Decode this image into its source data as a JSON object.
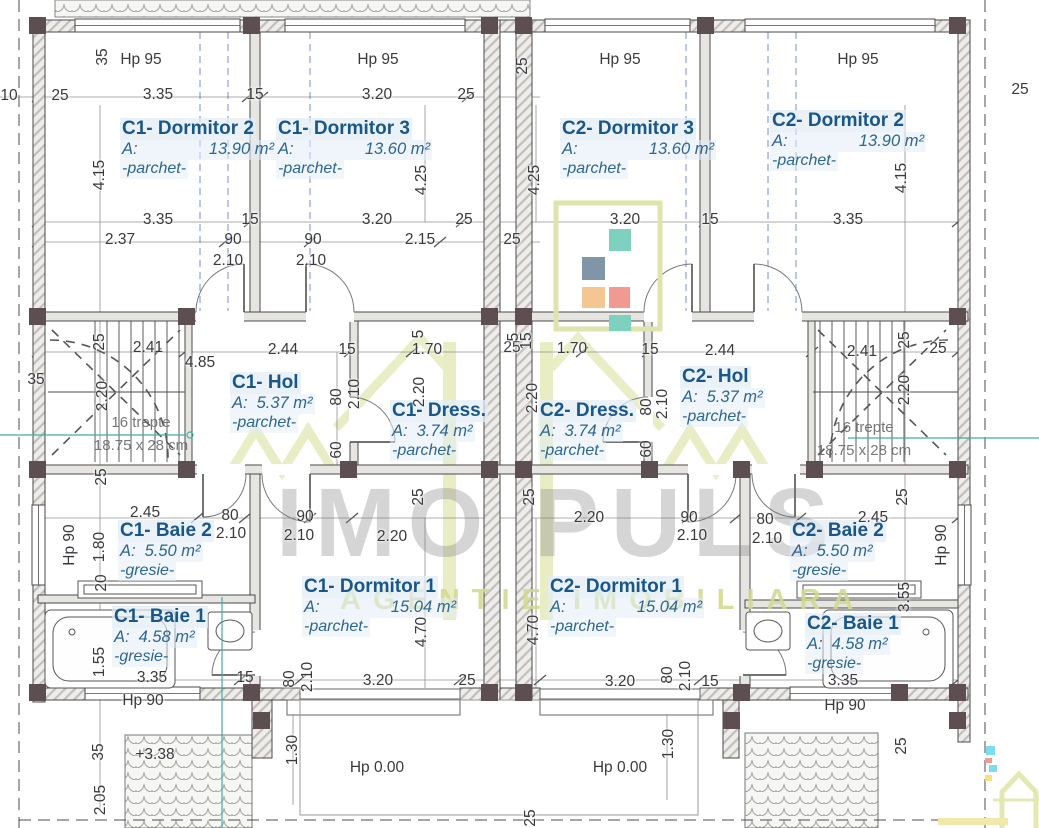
{
  "plan": {
    "watermark": {
      "brand": "IMO PULS",
      "tagline": "AGENTIE IMOBILIARA"
    },
    "stair_note": {
      "line1": "16 trepte",
      "line2": "18.75 x 28 cm"
    },
    "colors": {
      "room_label": "#19578a",
      "dimension": "#3a3a3e",
      "watermark_gray": "#bdbdbd",
      "watermark_green": "#dfe4ad",
      "logo_teal": "#7ed0bf",
      "logo_slate": "#8195a9",
      "logo_orange": "#f4c792",
      "logo_coral": "#f09a92",
      "axis_blue": "#5b6cc7",
      "level_teal": "#3ab0a5"
    },
    "rooms": [
      {
        "id": "c1-dormitor-2",
        "name": "C1- Dormitor 2",
        "area_label": "A:",
        "area": "13.90 m²",
        "finish": "-parchet-",
        "x": 120,
        "y": 118,
        "spread": true
      },
      {
        "id": "c1-dormitor-3",
        "name": "C1- Dormitor 3",
        "area_label": "A:",
        "area": "13.60 m²",
        "finish": "-parchet-",
        "x": 276,
        "y": 118,
        "spread": true
      },
      {
        "id": "c2-dormitor-3",
        "name": "C2- Dormitor 3",
        "area_label": "A:",
        "area": "13.60 m²",
        "finish": "-parchet-",
        "x": 560,
        "y": 118,
        "spread": true
      },
      {
        "id": "c2-dormitor-2",
        "name": "C2- Dormitor 2",
        "area_label": "A:",
        "area": "13.90 m²",
        "finish": "-parchet-",
        "x": 770,
        "y": 110,
        "spread": true
      },
      {
        "id": "c1-hol",
        "name": "C1- Hol",
        "area_label": "A:",
        "area": "5.37 m²",
        "finish": "-parchet-",
        "x": 230,
        "y": 372
      },
      {
        "id": "c1-dress",
        "name": "C1- Dress.",
        "area_label": "A:",
        "area": "3.74 m²",
        "finish": "-parchet-",
        "x": 390,
        "y": 400
      },
      {
        "id": "c2-dress",
        "name": "C2- Dress.",
        "area_label": "A:",
        "area": "3.74 m²",
        "finish": "-parchet-",
        "x": 538,
        "y": 400
      },
      {
        "id": "c2-hol",
        "name": "C2- Hol",
        "area_label": "A:",
        "area": "5.37 m²",
        "finish": "-parchet-",
        "x": 680,
        "y": 366
      },
      {
        "id": "c1-baie-2",
        "name": "C1- Baie 2",
        "area_label": "A:",
        "area": "5.50 m²",
        "finish": "-gresie-",
        "x": 118,
        "y": 520
      },
      {
        "id": "c2-baie-2",
        "name": "C2- Baie 2",
        "area_label": "A:",
        "area": "5.50 m²",
        "finish": "-gresie-",
        "x": 790,
        "y": 520
      },
      {
        "id": "c1-baie-1",
        "name": "C1- Baie 1",
        "area_label": "A:",
        "area": "4.58 m²",
        "finish": "-gresie-",
        "x": 112,
        "y": 606
      },
      {
        "id": "c2-baie-1",
        "name": "C2- Baie 1",
        "area_label": "A:",
        "area": "4.58 m²",
        "finish": "-gresie-",
        "x": 805,
        "y": 613
      },
      {
        "id": "c1-dormitor-1",
        "name": "C1- Dormitor 1",
        "area_label": "A:",
        "area": "15.04 m²",
        "finish": "-parchet-",
        "x": 302,
        "y": 576,
        "spread": true
      },
      {
        "id": "c2-dormitor-1",
        "name": "C2- Dormitor 1",
        "area_label": "A:",
        "area": "15.04 m²",
        "finish": "-parchet-",
        "x": 548,
        "y": 576,
        "spread": true
      }
    ],
    "labels": [
      {
        "t": "35",
        "x": 103,
        "y": 57,
        "r": 1
      },
      {
        "t": "Hp 95",
        "x": 141,
        "y": 60
      },
      {
        "t": "Hp 95",
        "x": 378,
        "y": 60
      },
      {
        "t": "25",
        "x": 523,
        "y": 66,
        "r": 1
      },
      {
        "t": "Hp 95",
        "x": 620,
        "y": 60
      },
      {
        "t": "Hp 95",
        "x": 858,
        "y": 60
      },
      {
        "t": "25",
        "x": 1020,
        "y": 90
      },
      {
        "t": "10",
        "x": 9,
        "y": 96
      },
      {
        "t": "25",
        "x": 60,
        "y": 96
      },
      {
        "t": "3.35",
        "x": 158,
        "y": 95
      },
      {
        "t": "15",
        "x": 255,
        "y": 95
      },
      {
        "t": "3.20",
        "x": 377,
        "y": 95
      },
      {
        "t": "25",
        "x": 466,
        "y": 95
      },
      {
        "t": "4.15",
        "x": 100,
        "y": 175,
        "r": 1
      },
      {
        "t": "4.25",
        "x": 422,
        "y": 180,
        "r": 1
      },
      {
        "t": "4.25",
        "x": 535,
        "y": 180,
        "r": 1
      },
      {
        "t": "4.15",
        "x": 902,
        "y": 178,
        "r": 1
      },
      {
        "t": "3.35",
        "x": 158,
        "y": 220
      },
      {
        "t": "15",
        "x": 250,
        "y": 220
      },
      {
        "t": "3.20",
        "x": 377,
        "y": 220
      },
      {
        "t": "25",
        "x": 464,
        "y": 220
      },
      {
        "t": "3.20",
        "x": 625,
        "y": 220
      },
      {
        "t": "15",
        "x": 710,
        "y": 220
      },
      {
        "t": "3.35",
        "x": 848,
        "y": 220
      },
      {
        "t": "2.37",
        "x": 120,
        "y": 240
      },
      {
        "t": "90",
        "x": 233,
        "y": 240
      },
      {
        "t": "2.10",
        "x": 228,
        "y": 261
      },
      {
        "t": "90",
        "x": 313,
        "y": 240
      },
      {
        "t": "2.10",
        "x": 311,
        "y": 261
      },
      {
        "t": "2.15",
        "x": 420,
        "y": 240
      },
      {
        "t": "25",
        "x": 512,
        "y": 240
      },
      {
        "t": "25",
        "x": 512,
        "y": 348
      },
      {
        "t": "2.41",
        "x": 148,
        "y": 348
      },
      {
        "t": "4.85",
        "x": 200,
        "y": 363
      },
      {
        "t": "2.44",
        "x": 283,
        "y": 350
      },
      {
        "t": "15",
        "x": 347,
        "y": 350
      },
      {
        "t": "1.70",
        "x": 427,
        "y": 350
      },
      {
        "t": "5",
        "x": 419,
        "y": 334,
        "r": 1
      },
      {
        "t": "5",
        "x": 514,
        "y": 337,
        "r": 1
      },
      {
        "t": "15",
        "x": 527,
        "y": 341,
        "r": 1
      },
      {
        "t": "1.70",
        "x": 572,
        "y": 349
      },
      {
        "t": "15",
        "x": 650,
        "y": 350
      },
      {
        "t": "2.44",
        "x": 720,
        "y": 351
      },
      {
        "t": "2.41",
        "x": 862,
        "y": 352
      },
      {
        "t": "25",
        "x": 938,
        "y": 349
      },
      {
        "t": "35",
        "x": 36,
        "y": 380
      },
      {
        "t": "25",
        "x": 100,
        "y": 342,
        "r": 1
      },
      {
        "t": "25",
        "x": 905,
        "y": 340,
        "r": 1
      },
      {
        "t": "2.20",
        "x": 103,
        "y": 396,
        "r": 1
      },
      {
        "t": "2.20",
        "x": 420,
        "y": 392,
        "r": 1
      },
      {
        "t": "2.20",
        "x": 533,
        "y": 398,
        "r": 1
      },
      {
        "t": "2.20",
        "x": 905,
        "y": 390,
        "r": 1
      },
      {
        "t": "80",
        "x": 337,
        "y": 397,
        "r": 1
      },
      {
        "t": "2.10",
        "x": 355,
        "y": 394,
        "r": 1
      },
      {
        "t": "60",
        "x": 337,
        "y": 450,
        "r": 1
      },
      {
        "t": "80",
        "x": 647,
        "y": 407,
        "r": 1
      },
      {
        "t": "2.10",
        "x": 663,
        "y": 404,
        "r": 1
      },
      {
        "t": "60",
        "x": 647,
        "y": 449,
        "r": 1
      },
      {
        "t": "25",
        "x": 102,
        "y": 477,
        "r": 1
      },
      {
        "t": "2.45",
        "x": 145,
        "y": 513
      },
      {
        "t": "80",
        "x": 230,
        "y": 516
      },
      {
        "t": "2.10",
        "x": 231,
        "y": 534
      },
      {
        "t": "90",
        "x": 305,
        "y": 517
      },
      {
        "t": "2.10",
        "x": 299,
        "y": 536
      },
      {
        "t": "2.20",
        "x": 392,
        "y": 537
      },
      {
        "t": "2.20",
        "x": 589,
        "y": 518
      },
      {
        "t": "90",
        "x": 689,
        "y": 518
      },
      {
        "t": "2.10",
        "x": 692,
        "y": 536
      },
      {
        "t": "80",
        "x": 765,
        "y": 520
      },
      {
        "t": "2.10",
        "x": 767,
        "y": 539
      },
      {
        "t": "2.45",
        "x": 873,
        "y": 518
      },
      {
        "t": "25",
        "x": 419,
        "y": 497,
        "r": 1
      },
      {
        "t": "25",
        "x": 530,
        "y": 497,
        "r": 1
      },
      {
        "t": "25",
        "x": 903,
        "y": 497,
        "r": 1
      },
      {
        "t": "Hp 90",
        "x": 70,
        "y": 545,
        "r": 1
      },
      {
        "t": "1.80",
        "x": 100,
        "y": 547,
        "r": 1
      },
      {
        "t": "20",
        "x": 102,
        "y": 583,
        "r": 1
      },
      {
        "t": "1.55",
        "x": 100,
        "y": 662,
        "r": 1
      },
      {
        "t": "Hp 90",
        "x": 942,
        "y": 545,
        "r": 1
      },
      {
        "t": "3.55",
        "x": 905,
        "y": 597,
        "r": 1
      },
      {
        "t": "4.70",
        "x": 422,
        "y": 632,
        "r": 1
      },
      {
        "t": "4.70",
        "x": 534,
        "y": 630,
        "r": 1
      },
      {
        "t": "3.35",
        "x": 152,
        "y": 678
      },
      {
        "t": "15",
        "x": 245,
        "y": 678
      },
      {
        "t": "80",
        "x": 290,
        "y": 679,
        "r": 1
      },
      {
        "t": "2.10",
        "x": 308,
        "y": 677,
        "r": 1
      },
      {
        "t": "3.20",
        "x": 378,
        "y": 681
      },
      {
        "t": "25",
        "x": 467,
        "y": 681
      },
      {
        "t": "3.20",
        "x": 620,
        "y": 682
      },
      {
        "t": "80",
        "x": 668,
        "y": 675,
        "r": 1
      },
      {
        "t": "2.10",
        "x": 686,
        "y": 676,
        "r": 1
      },
      {
        "t": "15",
        "x": 710,
        "y": 682
      },
      {
        "t": "3.35",
        "x": 843,
        "y": 681
      },
      {
        "t": "Hp 90",
        "x": 143,
        "y": 701
      },
      {
        "t": "Hp 90",
        "x": 845,
        "y": 706
      },
      {
        "t": "35",
        "x": 99,
        "y": 752,
        "r": 1
      },
      {
        "t": "+3.38",
        "x": 155,
        "y": 755
      },
      {
        "t": "1.30",
        "x": 293,
        "y": 750,
        "r": 1
      },
      {
        "t": "1.30",
        "x": 669,
        "y": 744,
        "r": 1
      },
      {
        "t": "Hp 0.00",
        "x": 377,
        "y": 768
      },
      {
        "t": "Hp 0.00",
        "x": 620,
        "y": 768
      },
      {
        "t": "2.05",
        "x": 101,
        "y": 800,
        "r": 1
      },
      {
        "t": "25",
        "x": 531,
        "y": 818,
        "r": 1
      },
      {
        "t": "25",
        "x": 902,
        "y": 746,
        "r": 1
      }
    ]
  }
}
